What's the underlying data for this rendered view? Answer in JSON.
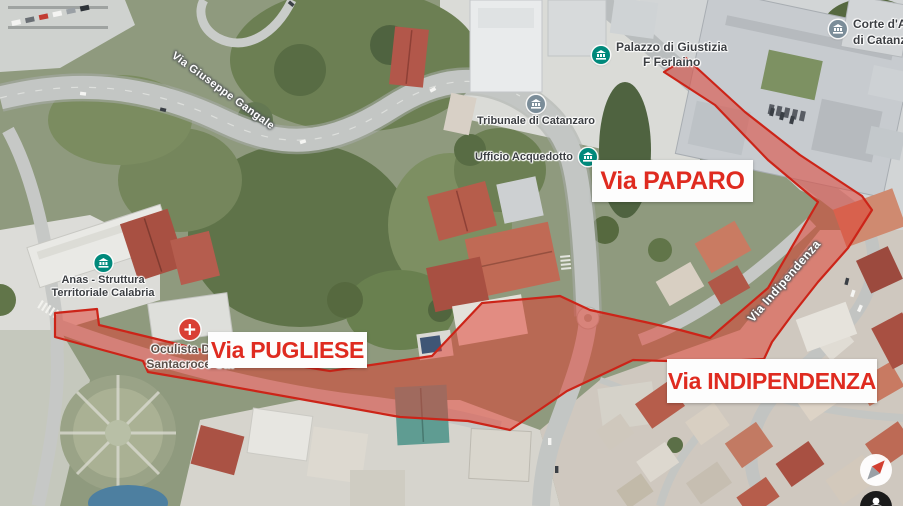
{
  "map": {
    "type": "satellite-map",
    "city": "Catanzaro",
    "poi": {
      "tribunale": {
        "label": "Tribunale di Catanzaro"
      },
      "ufficio": {
        "label": "Ufficio Acquedotto"
      },
      "palazzo": {
        "line1": "Palazzo di Giustizia",
        "line2": "F Ferlaino"
      },
      "corte": {
        "line1": "Corte d'Appello",
        "line2": "di Catanzaro"
      },
      "anas": {
        "line1": "Anas - Struttura",
        "line2": "Territoriale Calabria"
      },
      "oculista": {
        "line1": "Oculista Dr. N",
        "line2": "Santacroce Cat"
      }
    },
    "streets": {
      "gangale": "Via Giuseppe Gangale",
      "indipendenza_street": "Via Indipendenza"
    },
    "highlights": {
      "paparo": "Via PAPARO",
      "pugliese": "Via PUGLIESE",
      "indipendenza": "Via INDIPENDENZA"
    },
    "colors": {
      "highlight_text": "#df2b20",
      "overlay_fill": "#e1382a",
      "overlay_stroke": "#cc2418",
      "poi_teal": "#00897b",
      "poi_gray": "#7b8d99",
      "pin_red": "#d93f34",
      "compass_red": "#d23f31"
    }
  }
}
